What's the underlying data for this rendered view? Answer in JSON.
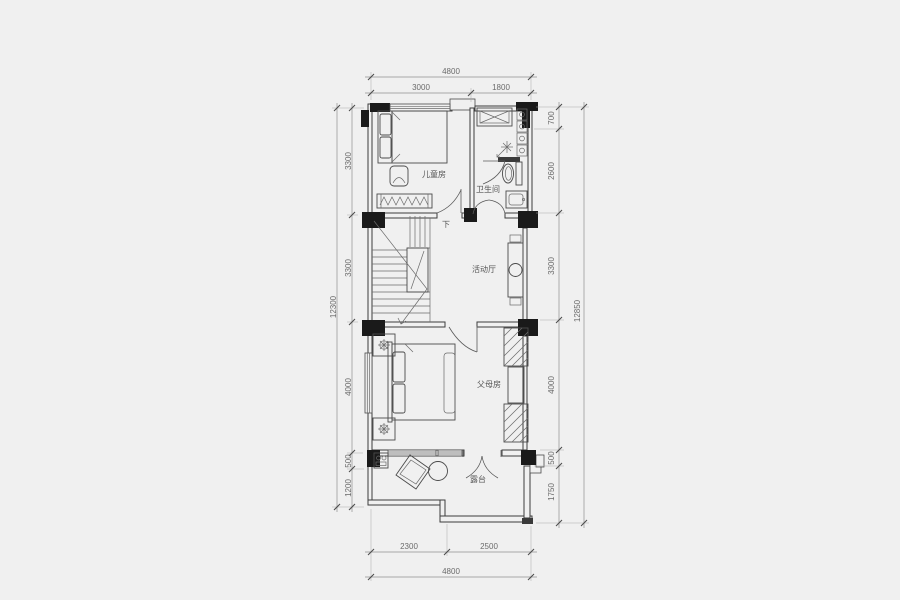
{
  "drawing": {
    "rooms": {
      "childrens_room": "儿童房",
      "bathroom": "卫生间",
      "activity_hall": "活动厅",
      "parents_room": "父母房",
      "terrace": "露台"
    },
    "stair_direction": "下",
    "dimensions": {
      "top": {
        "overall": "4800",
        "segments": [
          "3000",
          "1800"
        ]
      },
      "bottom": {
        "overall": "4800",
        "segments": [
          "2300",
          "2500"
        ]
      },
      "left": {
        "overall": "12300",
        "segments": [
          "3300",
          "3300",
          "4000",
          "500",
          "1200"
        ]
      },
      "right": {
        "overall": "12850",
        "segments": [
          "700",
          "2600",
          "3300",
          "4000",
          "500",
          "1750"
        ]
      }
    },
    "colors": {
      "background": "#f0f0f0",
      "wall_line": "#3d3d3d",
      "column_fill": "#1a1a1a",
      "dim_text": "#6b6b6b"
    }
  }
}
